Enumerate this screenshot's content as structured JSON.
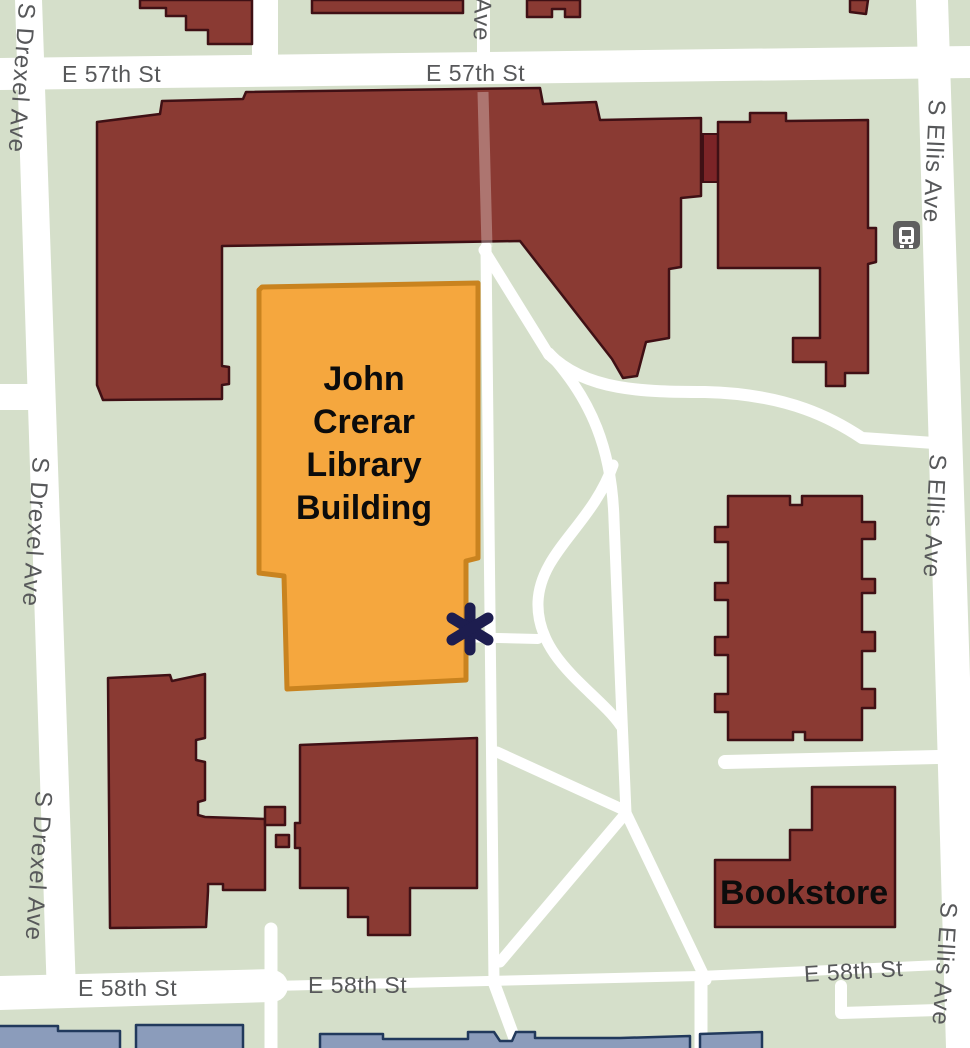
{
  "map": {
    "colors": {
      "background": "#d5dfca",
      "road": "#ffffff",
      "building_fill": "#8a3a33",
      "building_stroke": "#3f1015",
      "building_dark": "#7c2427",
      "highlight_fill": "#f5a73e",
      "highlight_stroke": "#c9831f",
      "blue_fill": "#8b9cbb",
      "blue_stroke": "#21395c",
      "street_label": "#57585a",
      "building_label": "#0c0c0c",
      "marker": "#1d1d4f",
      "bus_icon_bg": "#5f5f5f"
    },
    "streets": {
      "e57": "E 57th St",
      "e58": "E 58th St",
      "drexel": "S Drexel Ave",
      "ellis": "S Ellis Ave",
      "ave_partial": "Ave"
    },
    "buildings": {
      "crerar": {
        "name": "John Crerar Library Building",
        "lines": [
          "John",
          "Crerar",
          "Library",
          "Building"
        ]
      },
      "bookstore": {
        "name": "Bookstore"
      }
    },
    "marker": {
      "name": "entrance-asterisk",
      "glyph": "✱"
    },
    "transit": {
      "name": "bus-stop"
    }
  }
}
